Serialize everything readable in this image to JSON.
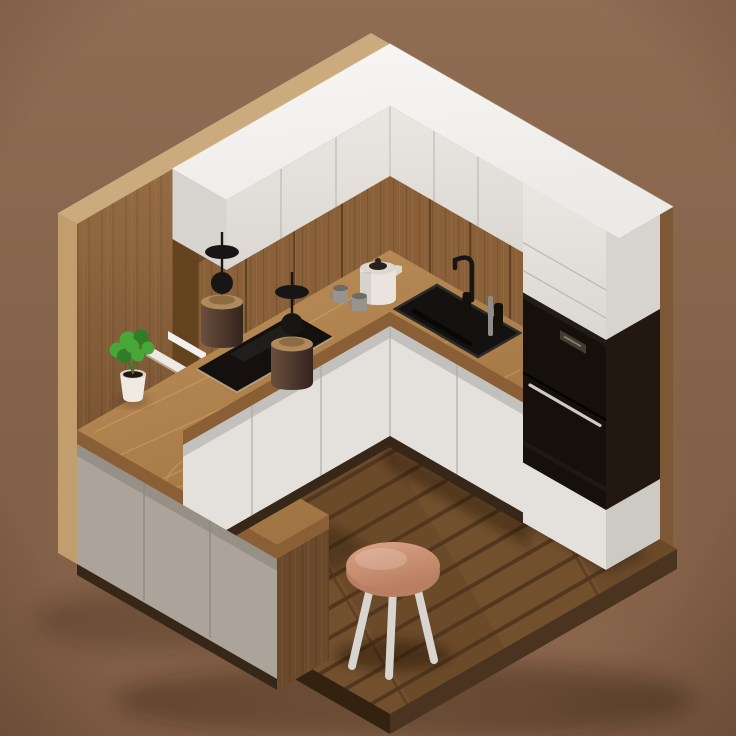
{
  "scene": {
    "title": "Isometric 3D miniature kitchen render",
    "description": "Low-poly isometric 3D diorama of a modern kitchen corner: oak wood walls and walnut plank floor, white upper cabinets with a bright white top slab, wood-front wall cabinets, L-shaped oak countertop with black induction cooktop and black sink, white base cabinets, a taupe peninsula cabinet, a tall unit with two black built-in ovens, two brown cylinder pendant lamps, a white wall sconce, a potted green plant, a cream kettle with two grey mugs, and a round wooden stool on the floor.",
    "style": "isometric low-poly 3D render",
    "background": "warm brown studio backdrop",
    "pendant_count": 2,
    "mug_count": 2,
    "oven_count": 2
  },
  "objects": [
    {
      "name": "left-wall",
      "label": "Oak wall (left)"
    },
    {
      "name": "right-wall",
      "label": "Oak wall (right)"
    },
    {
      "name": "floor",
      "label": "Walnut plank floor"
    },
    {
      "name": "upper-cabinets",
      "label": "White upper cabinets"
    },
    {
      "name": "wood-wall-cabinets",
      "label": "Wood-front wall cabinets"
    },
    {
      "name": "countertop",
      "label": "L-shaped oak countertop"
    },
    {
      "name": "peninsula-cabinet",
      "label": "Peninsula base cabinet"
    },
    {
      "name": "base-cabinets",
      "label": "White base cabinets"
    },
    {
      "name": "tall-cabinet",
      "label": "Tall cabinet with built-in ovens"
    },
    {
      "name": "oven-upper",
      "label": "Built-in oven (upper)"
    },
    {
      "name": "oven-lower",
      "label": "Built-in oven (lower)"
    },
    {
      "name": "cooktop",
      "label": "Black induction cooktop"
    },
    {
      "name": "sink",
      "label": "Black undermount sink"
    },
    {
      "name": "faucet",
      "label": "Black faucet and soap bottles"
    },
    {
      "name": "kettle",
      "label": "Cream kettle"
    },
    {
      "name": "mugs",
      "label": "Two grey mugs"
    },
    {
      "name": "pendant-lamp-1",
      "label": "Pendant lamp"
    },
    {
      "name": "pendant-lamp-2",
      "label": "Pendant lamp"
    },
    {
      "name": "wall-sconce",
      "label": "White wall sconce"
    },
    {
      "name": "potted-plant",
      "label": "Potted plant in white pot"
    },
    {
      "name": "stool",
      "label": "Round wooden stool"
    }
  ],
  "palette": {
    "bg_top": "#8F6C52",
    "bg_bottom": "#7B5942",
    "bg_glow": "#A87E5F",
    "wall_left": "#A1764B",
    "wall_left_dark": "#6E4B2B",
    "wall_right": "#91683F",
    "wall_right_dark": "#5E3F24",
    "wall_rim": "#CBAB7D",
    "wall_edge_left": "#C29D6E",
    "wall_edge_right": "#7D5836",
    "floor": "#76522F",
    "floor_light": "#7E5933",
    "floor_mid": "#6F4D2C",
    "floor_seam": "#583A1F",
    "floor_edge_left": "#32220F",
    "floor_edge_right": "#4A3420",
    "counter": "#C0915B",
    "counter_dark": "#9C7140",
    "counter_edge": "#8A5F36",
    "counter_grain": "#DCAC6C",
    "white_top": "#F8F7F5",
    "white_top_low": "#ECEAE6",
    "white_face": "#EAE7E3",
    "white_face_low": "#DBD7D2",
    "white_side": "#D7D3CE",
    "white_seam": "#BDB8B1",
    "wood_cab": "#8A6039",
    "wood_cab_dark": "#64431F",
    "wood_cab_seam": "#4F3419",
    "lower_face": "#E4E1DD",
    "lower_face_low": "#CDC9C3",
    "lower_seam": "#AFAAA3",
    "peninsula_face": "#ACA49A",
    "peninsula_face_low": "#9790870",
    "peninsula_seam": "#8C857C",
    "peninsula_end_wood": "#6B4A2C",
    "plinth": "#362718",
    "appliance_black": "#16100B",
    "appliance_side": "#231811",
    "oven_handle": "#CFCAC2",
    "oven_display": "#433C33",
    "cooktop_black": "#13100D",
    "cooktop_glint": "#EFE4C9",
    "sink_black": "#141210",
    "sink_rim": "#2E2B28",
    "chrome": "#8F8D89",
    "lamp_black": "#181614",
    "lamp_shade": "#6B4F3E",
    "lamp_shade_dark": "#33241D",
    "lamp_ring": "#B08A5C",
    "plant_green": "#46A838",
    "plant_green_dark": "#2F7D26",
    "pot_white": "#EFEBE4",
    "pot_soil": "#23180F",
    "kettle_body": "#E9E5DE",
    "kettle_lid": "#26211D",
    "mug_grey": "#98938D",
    "stool_seat": "#DCA586",
    "stool_seat_dark": "#B97F62",
    "stool_legs": "#D8D5D0",
    "shadow": "#1D0F04"
  }
}
